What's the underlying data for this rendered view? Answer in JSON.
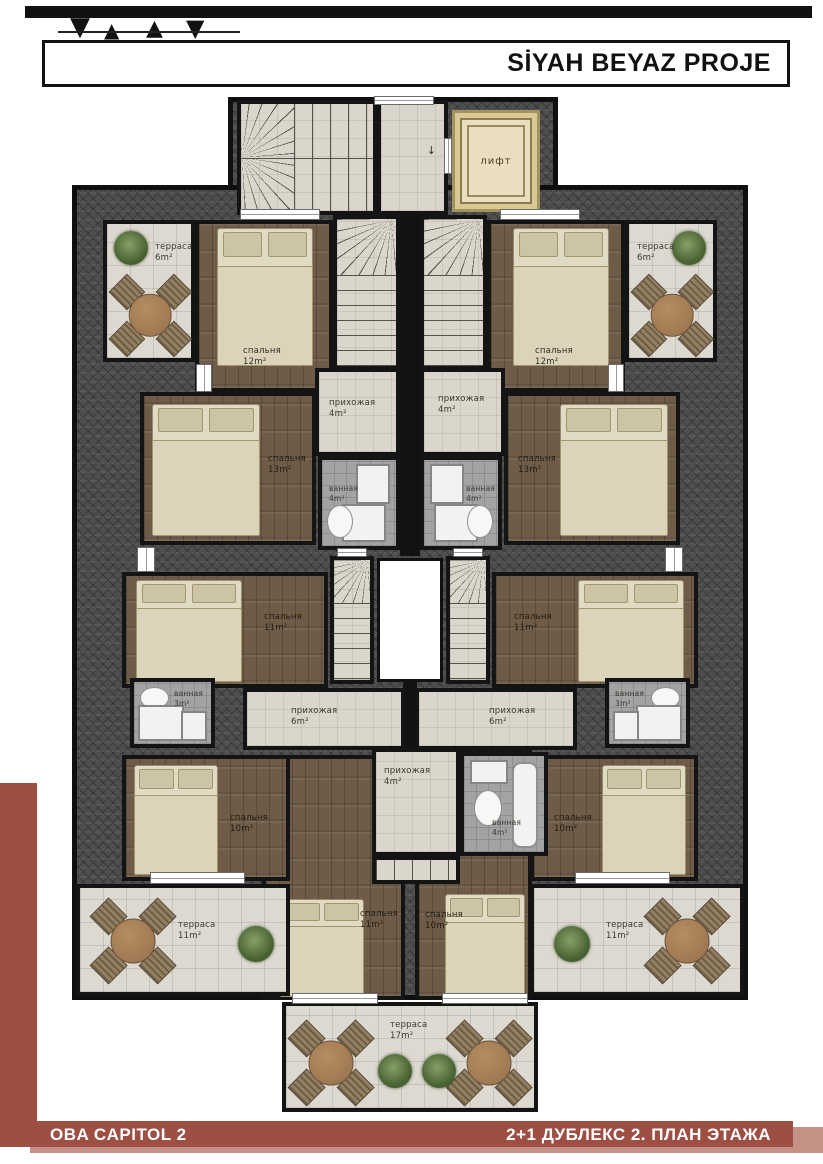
{
  "header": {
    "title": "SİYAH BEYAZ PROJE"
  },
  "footer": {
    "left": "OBA CAPITOL 2",
    "right": "2+1 ДУБЛЕКС 2. ПЛАН ЭТАЖА"
  },
  "icons": {
    "down_arrow": "↓",
    "birds": [
      "▼",
      "▲",
      "▲",
      "▼"
    ]
  },
  "colors": {
    "accent_maroon": "#9d4f43",
    "accent_maroon_light": "#c49186",
    "wall": "#121212",
    "roof_hatch": "#4e4e4e",
    "wood_floor": "#6e5c48",
    "tile_light": "#dad6cc",
    "tile_gray": "#a3a3a3",
    "lift_beige": "#e9dfc0",
    "bed_cream": "#e2dbc4"
  },
  "rooms": {
    "lift": {
      "name": "лифт"
    },
    "terrace_tl": {
      "name": "терраса",
      "area": "6m²"
    },
    "terrace_tr": {
      "name": "терраса",
      "area": "6m²"
    },
    "bedroom_tl": {
      "name": "спальня",
      "area": "12m²"
    },
    "bedroom_tr": {
      "name": "спальня",
      "area": "12m²"
    },
    "bedroom_ml": {
      "name": "спальня",
      "area": "13m²"
    },
    "bedroom_mr": {
      "name": "спальня",
      "area": "13m²"
    },
    "hall_ul": {
      "name": "прихожая",
      "area": "4m²"
    },
    "hall_ur": {
      "name": "прихожая",
      "area": "4m²"
    },
    "bath_ul": {
      "name": "ванная",
      "area": "4m²"
    },
    "bath_ur": {
      "name": "ванная",
      "area": "4m²"
    },
    "bedroom_cl": {
      "name": "спальня",
      "area": "11m²"
    },
    "bedroom_cr": {
      "name": "спальня",
      "area": "11m²"
    },
    "bath_sl": {
      "name": "ванная",
      "area": "3m²"
    },
    "bath_sr": {
      "name": "ванная",
      "area": "3m²"
    },
    "hall_ml": {
      "name": "прихожая",
      "area": "6m²"
    },
    "hall_mr": {
      "name": "прихожая",
      "area": "6m²"
    },
    "bedroom_bl": {
      "name": "спальня",
      "area": "10m²"
    },
    "bedroom_br": {
      "name": "спальня",
      "area": "10m²"
    },
    "hall_bc": {
      "name": "прихожая",
      "area": "4m²"
    },
    "bath_bc": {
      "name": "ванная",
      "area": "4m²"
    },
    "bedroom_bcl": {
      "name": "спальня",
      "area": "11m²"
    },
    "bedroom_bcr": {
      "name": "спальня",
      "area": "10m²"
    },
    "terrace_bl": {
      "name": "терраса",
      "area": "11m²"
    },
    "terrace_br": {
      "name": "терраса",
      "area": "11m²"
    },
    "terrace_bc": {
      "name": "терраса",
      "area": "17m²"
    }
  }
}
